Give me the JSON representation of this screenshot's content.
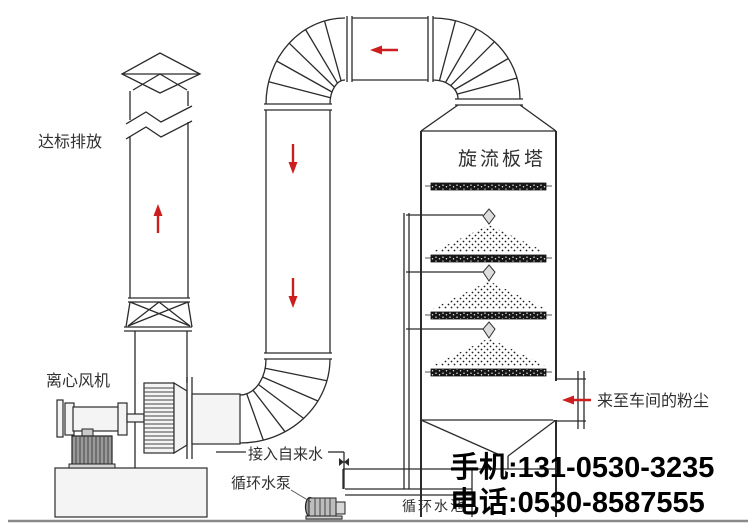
{
  "diagram": {
    "title_hint": "cyclone-plate-tower dust scrubbing system flow diagram",
    "labels": {
      "emission": "达标排放",
      "fan": "离心风机",
      "tower": "旋流板塔",
      "dust_inlet": "来至车间的粉尘",
      "tap_water": "接入自来水",
      "pump": "循环水泵",
      "pool": "循环水池"
    },
    "contact": {
      "mobile": "手机:131-0530-3235",
      "phone": "电话:0530-8587555"
    },
    "flow_arrows": [
      {
        "location": "chimney",
        "direction": "up"
      },
      {
        "location": "top-duct",
        "direction": "left"
      },
      {
        "location": "downcomer-duct-upper",
        "direction": "down"
      },
      {
        "location": "downcomer-duct-lower",
        "direction": "down"
      },
      {
        "location": "dust-inlet",
        "direction": "left"
      }
    ],
    "spray_levels": 3,
    "tray_plates": 4,
    "colors": {
      "line": "#2b2b2b",
      "arrow": "#cc1e1e",
      "contact_text": "#000000",
      "pool_label": "#9a9a9a",
      "background": "#ffffff"
    }
  }
}
